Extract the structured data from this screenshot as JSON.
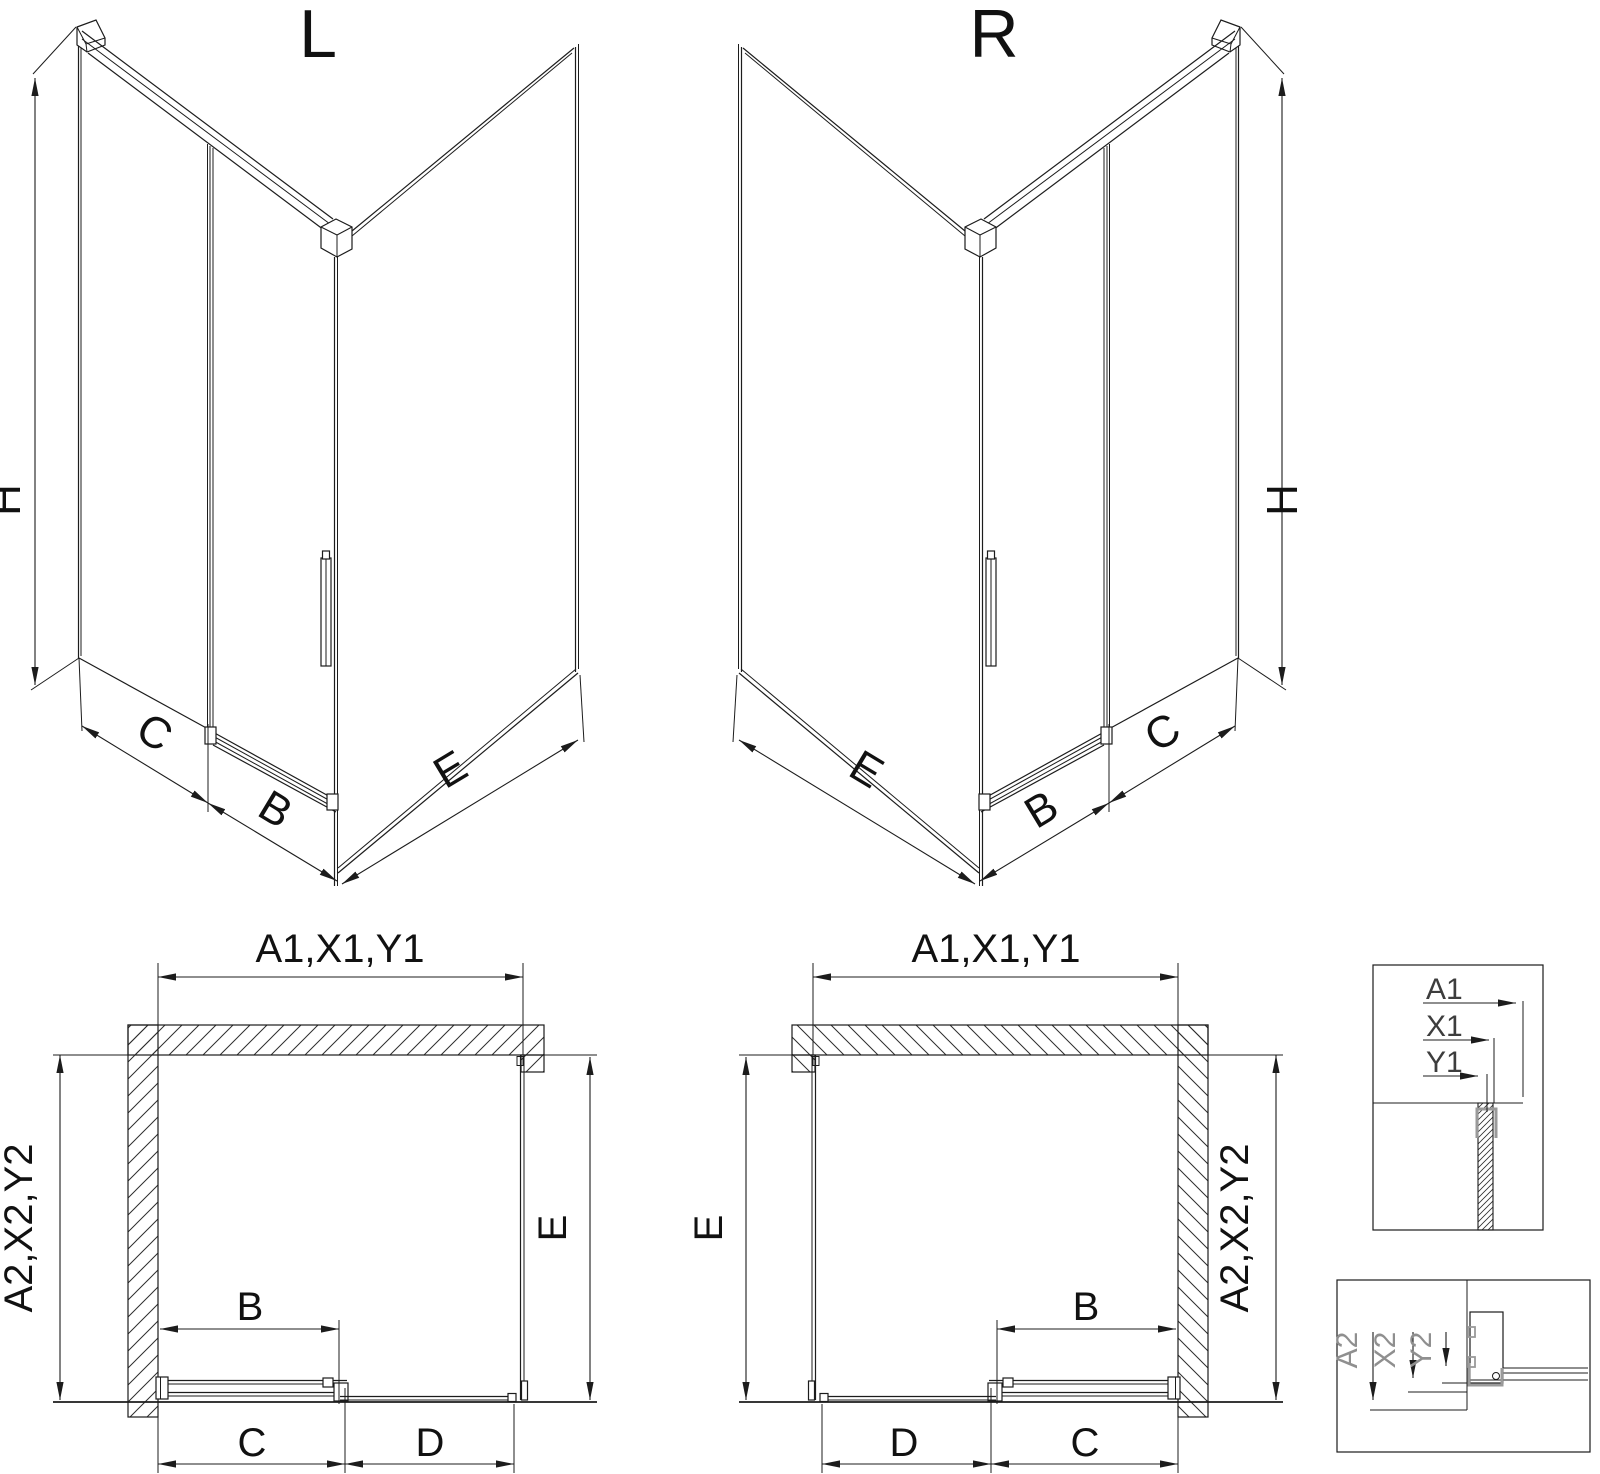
{
  "colors": {
    "line": "#1c1c1c",
    "gray_profile": "#9a9a9a",
    "background": "#ffffff"
  },
  "iso_left": {
    "title": "L",
    "dim_height": "H",
    "dim_fixed": "C",
    "dim_door": "B",
    "dim_return": "E"
  },
  "iso_right": {
    "title": "R",
    "dim_height": "H",
    "dim_fixed": "C",
    "dim_door": "B",
    "dim_return": "E"
  },
  "plan_left": {
    "dim_top": "A1,X1,Y1",
    "dim_side": "A2,X2,Y2",
    "dim_return": "E",
    "dim_door": "B",
    "dim_bottom_near_wall": "C",
    "dim_bottom_far": "D"
  },
  "plan_right": {
    "dim_top": "A1,X1,Y1",
    "dim_side": "A2,X2,Y2",
    "dim_return": "E",
    "dim_door": "B",
    "dim_bottom_near_wall": "C",
    "dim_bottom_far": "D"
  },
  "detail_top": {
    "labels": [
      "A1",
      "X1",
      "Y1"
    ]
  },
  "detail_bottom": {
    "labels": [
      "A2",
      "X2",
      "Y2"
    ]
  }
}
